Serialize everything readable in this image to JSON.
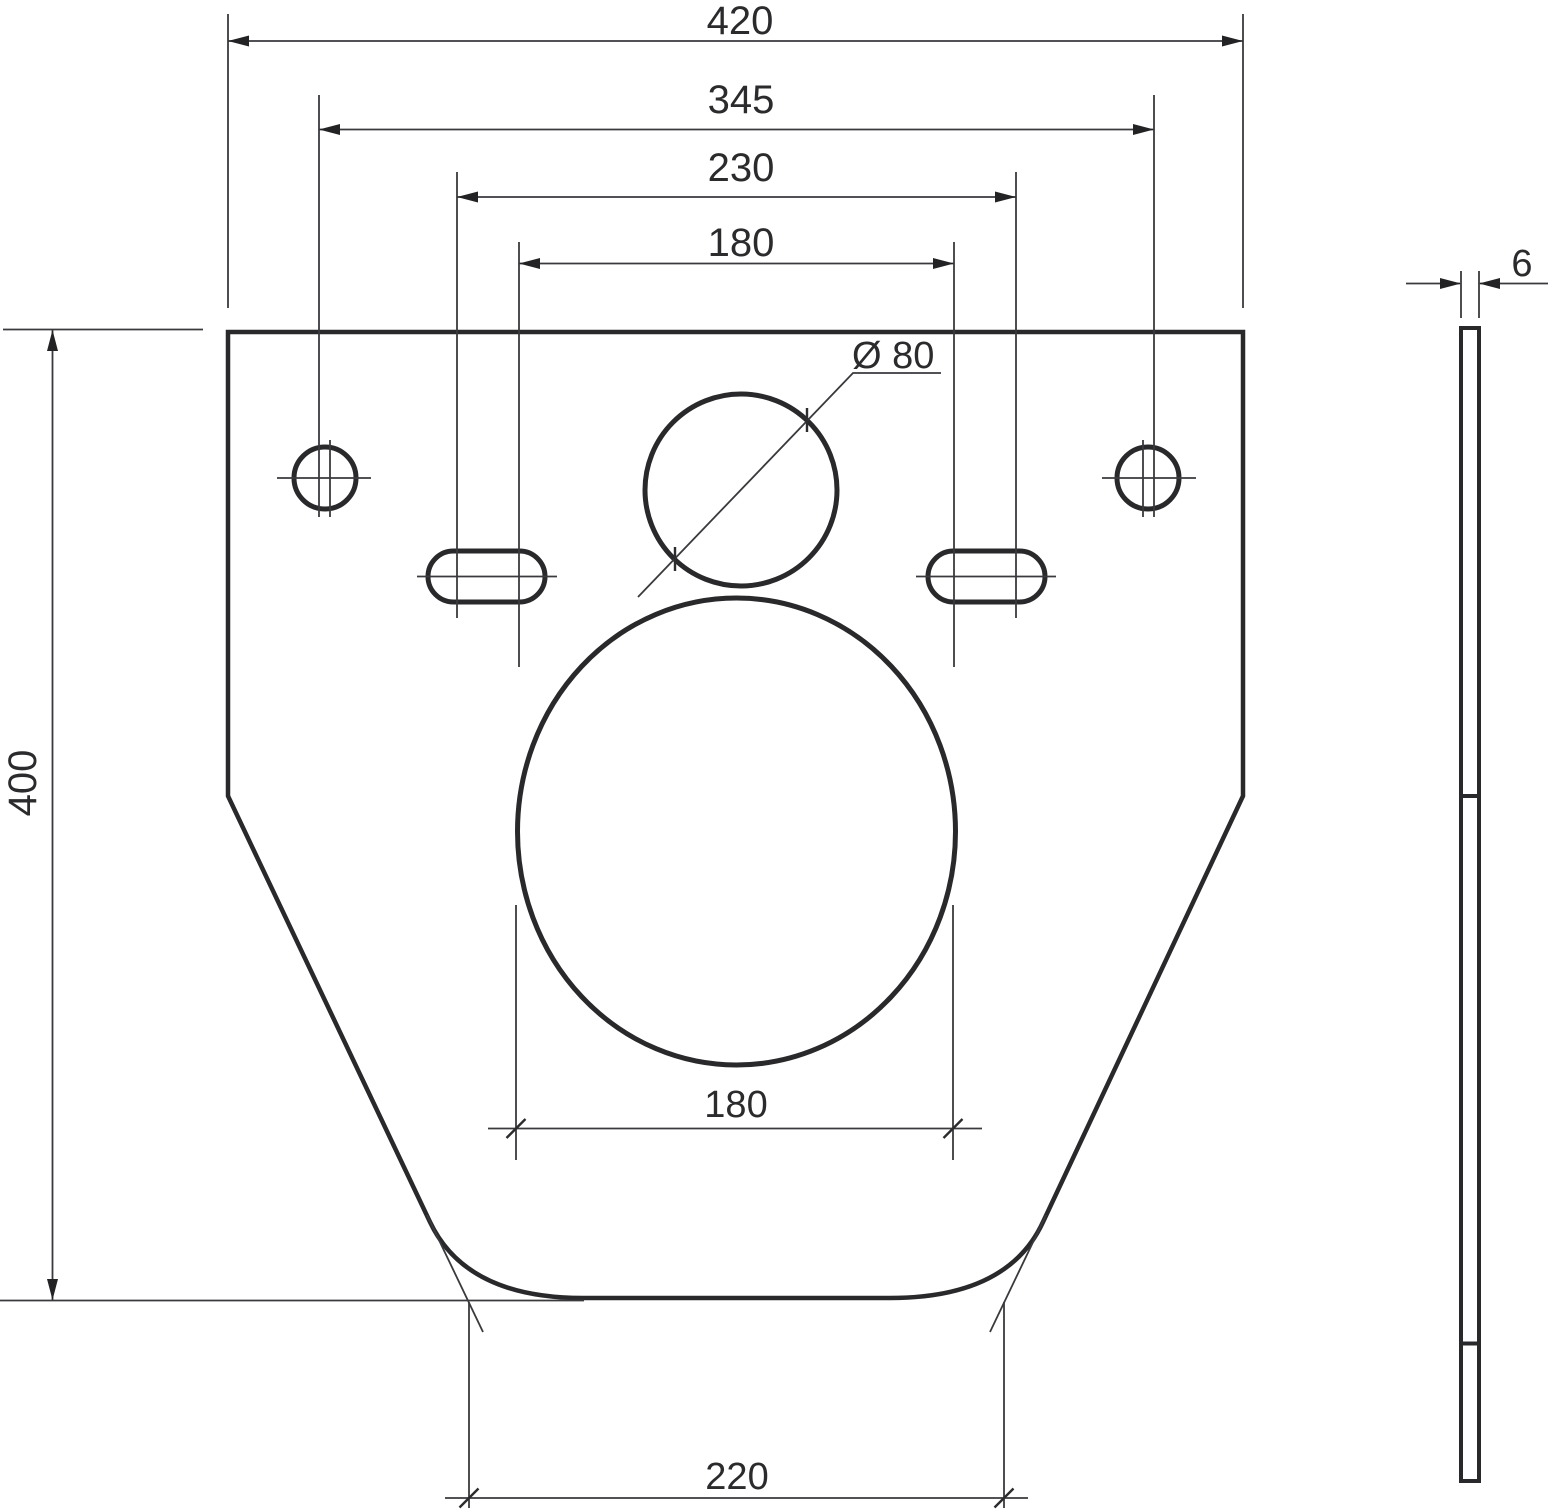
{
  "drawing": {
    "type": "technical-dimension-drawing",
    "units": "mm",
    "front_view": {
      "dim_overall_width": "420",
      "dim_mount_hole_spacing": "345",
      "dim_bolt_spacing_wide": "230",
      "dim_bolt_spacing_narrow": "180",
      "dim_overall_height": "400",
      "dim_pipe_hole_diameter": "Ø 80",
      "dim_opening_width": "180",
      "dim_bottom_flat_width": "220"
    },
    "side_view": {
      "dim_thickness": "6"
    }
  }
}
